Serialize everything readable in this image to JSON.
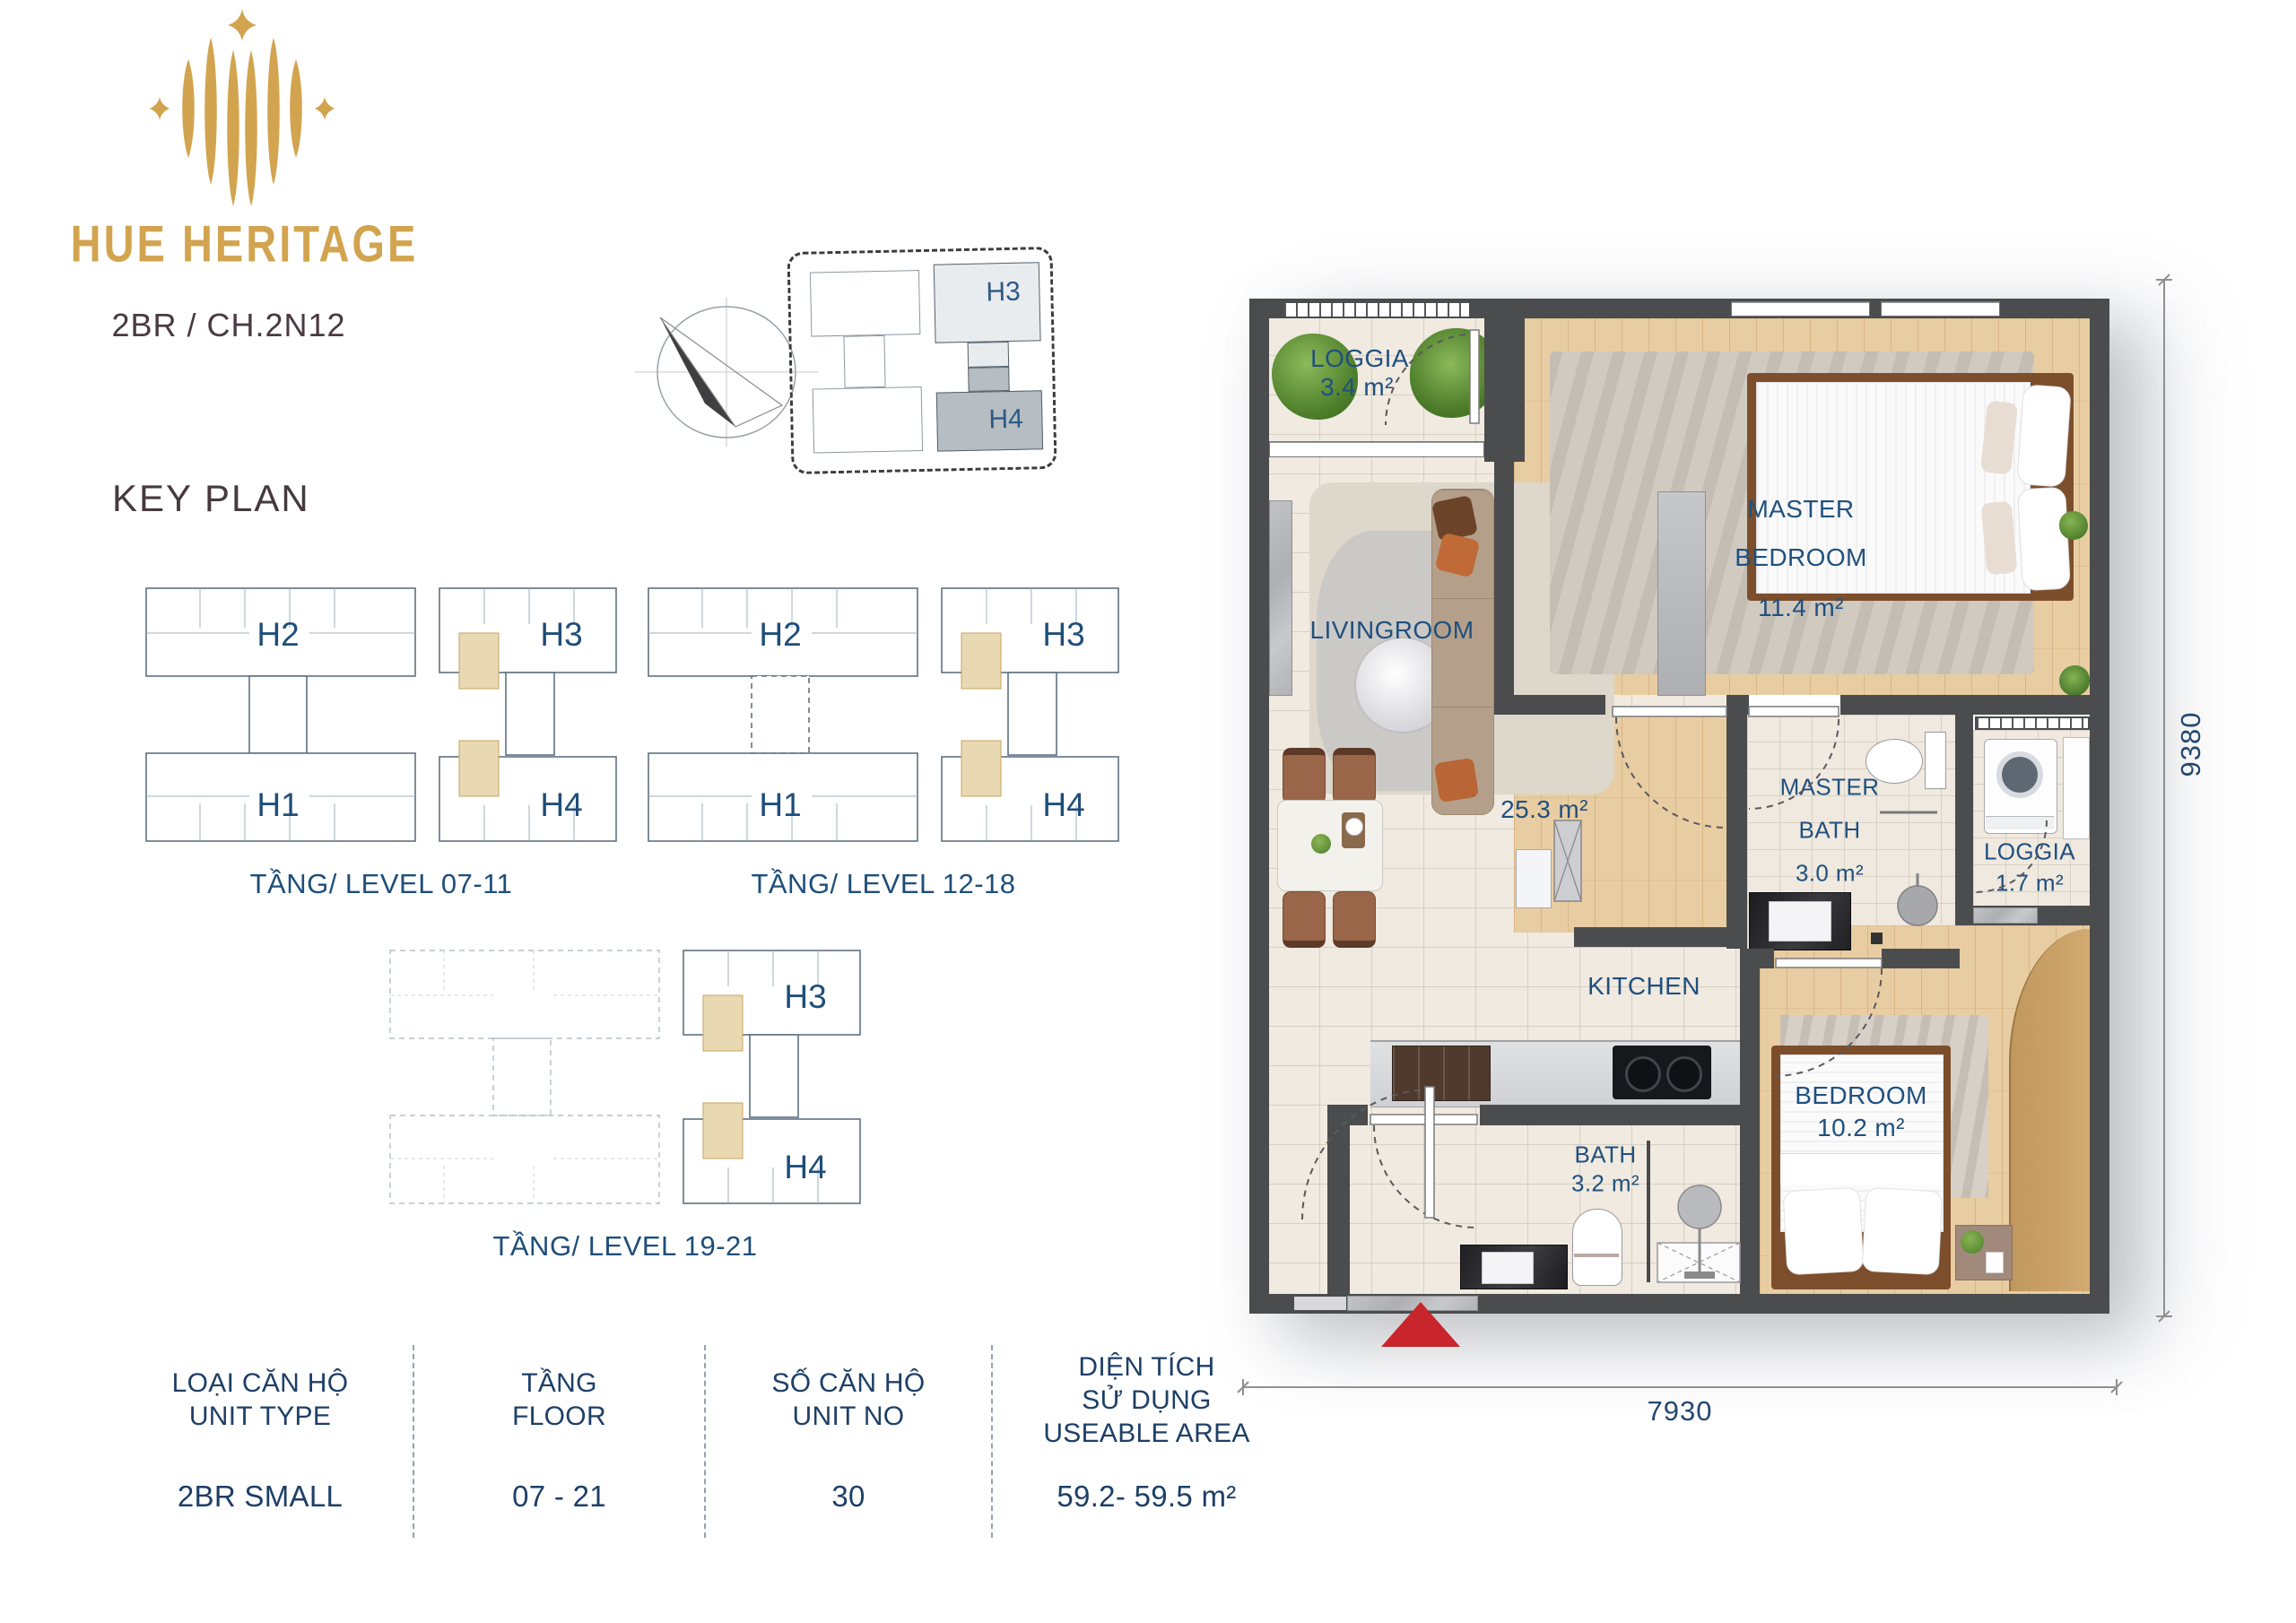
{
  "brand": {
    "name": "HUE HERITAGE",
    "unit_code": "2BR / CH.2N12",
    "gold": "#D2A44F",
    "navy": "#1F4E79"
  },
  "site_overview": {
    "h3": "H3",
    "h4": "H4"
  },
  "key_plan": {
    "heading": "KEY PLAN",
    "plans": [
      {
        "label": "TẦNG/ LEVEL 07-11",
        "left_top": "H2",
        "left_bottom": "H1",
        "right_top": "H3",
        "right_bottom": "H4"
      },
      {
        "label": "TẦNG/ LEVEL 12-18",
        "left_top": "H2",
        "left_bottom": "H1",
        "right_top": "H3",
        "right_bottom": "H4"
      },
      {
        "label": "TẦNG/ LEVEL 19-21",
        "right_top": "H3",
        "right_bottom": "H4"
      }
    ]
  },
  "info_table": {
    "columns": [
      {
        "header_line1": "LOẠI CĂN HỘ",
        "header_line2": "UNIT TYPE",
        "header_line3": "",
        "value": "2BR SMALL"
      },
      {
        "header_line1": "TẦNG",
        "header_line2": "FLOOR",
        "header_line3": "",
        "value": "07 - 21"
      },
      {
        "header_line1": "SỐ CĂN HỘ",
        "header_line2": "UNIT NO",
        "header_line3": "",
        "value": "30"
      },
      {
        "header_line1": "DIỆN TÍCH",
        "header_line2": "SỬ DỤNG",
        "header_line3": "USEABLE AREA",
        "value": "59.2- 59.5 m²"
      }
    ]
  },
  "floor_plan": {
    "rooms": {
      "loggia_top": {
        "name": "LOGGIA",
        "area": "3.4 m²"
      },
      "master_bedroom": {
        "name_line1": "MASTER",
        "name_line2": "BEDROOM",
        "area": "11.4 m²"
      },
      "livingroom": {
        "name": "LIVINGROOM",
        "area": "25.3 m²"
      },
      "master_bath": {
        "name_line1": "MASTER",
        "name_line2": "BATH",
        "area": "3.0 m²"
      },
      "loggia_side": {
        "name": "LOGGIA",
        "area": "1.7 m²"
      },
      "kitchen": {
        "name": "KITCHEN"
      },
      "bath": {
        "name": "BATH",
        "area": "3.2 m²"
      },
      "bedroom": {
        "name": "BEDROOM",
        "area": "10.2 m²"
      }
    },
    "dimensions": {
      "width_mm": "7930",
      "height_mm": "9380"
    }
  }
}
